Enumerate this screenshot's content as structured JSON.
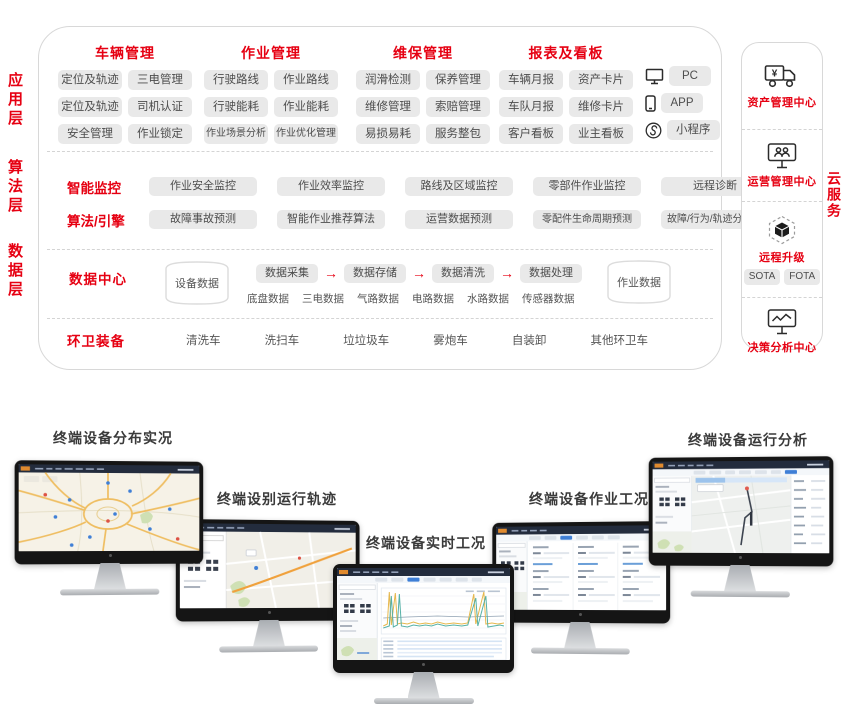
{
  "colors": {
    "accent_red": "#e60012",
    "chip_bg": "#e9e9e9",
    "chip_text": "#4d4d4d",
    "navy_bar": "#232c3d",
    "border_gray": "#d8d8d8"
  },
  "arch": {
    "layers": [
      {
        "label": "应用层"
      },
      {
        "label": "算法层"
      },
      {
        "label": "数据层"
      }
    ],
    "app_groups": [
      {
        "title": "车辆管理",
        "chips": [
          "定位及轨迹",
          "三电管理",
          "定位及轨迹",
          "司机认证",
          "安全管理",
          "作业锁定"
        ]
      },
      {
        "title": "作业管理",
        "chips": [
          "行驶路线",
          "作业路线",
          "行驶能耗",
          "作业能耗",
          "作业场景分析",
          "作业优化管理"
        ]
      },
      {
        "title": "维保管理",
        "chips": [
          "润滑检测",
          "保养管理",
          "维修管理",
          "索赔管理",
          "易损易耗",
          "服务整包"
        ]
      },
      {
        "title": "报表及看板",
        "chips": [
          "车辆月报",
          "资产卡片",
          "车队月报",
          "维修卡片",
          "客户看板",
          "业主看板"
        ]
      }
    ],
    "devices": [
      {
        "icon": "pc-icon",
        "label": "PC"
      },
      {
        "icon": "phone-icon",
        "label": "APP"
      },
      {
        "icon": "miniprogram-icon",
        "label": "小程序"
      }
    ],
    "algo_rows": [
      {
        "title": "智能监控",
        "chips": [
          "作业安全监控",
          "作业效率监控",
          "路线及区域监控",
          "零部件作业监控",
          "远程诊断"
        ]
      },
      {
        "title": "算法/引擎",
        "chips": [
          "故障事故预测",
          "智能作业推荐算法",
          "运营数据预测",
          "零配件生命周期预测",
          "故障/行为/轨迹分析引擎"
        ]
      }
    ],
    "data_layer": {
      "title": "数据中心",
      "cylinder_left": "设备数据",
      "pipeline": [
        "数据采集",
        "数据存储",
        "数据清洗",
        "数据处理"
      ],
      "sources": [
        "底盘数据",
        "三电数据",
        "气路数据",
        "电路数据",
        "水路数据",
        "传感器数据"
      ],
      "cylinder_right": "作业数据"
    },
    "equipment": {
      "title": "环卫装备",
      "items": [
        "清洗车",
        "洗扫车",
        "垃垃圾车",
        "雾炮车",
        "自装卸",
        "其他环卫车"
      ]
    }
  },
  "cloud": {
    "vertical_label": "云服务",
    "sections": [
      {
        "icon": "truck-yen-icon",
        "title": "资产管理中心",
        "chips": []
      },
      {
        "icon": "monitor-users-icon",
        "title": "运营管理中心",
        "chips": []
      },
      {
        "icon": "cube-hex-icon",
        "title": "远程升级",
        "chips": [
          "SOTA",
          "FOTA"
        ]
      },
      {
        "icon": "monitor-chart-icon",
        "title": "决策分析中心",
        "chips": []
      }
    ]
  },
  "monitors": [
    {
      "label": "终端设备分布实况",
      "screen": "map-overview"
    },
    {
      "label": "终端设别运行轨迹",
      "screen": "trajectory-map"
    },
    {
      "label": "终端设备实时工况",
      "screen": "realtime-charts"
    },
    {
      "label": "终端设备作业工况",
      "screen": "work-table"
    },
    {
      "label": "终端设备运行分析",
      "screen": "analysis-map"
    }
  ]
}
